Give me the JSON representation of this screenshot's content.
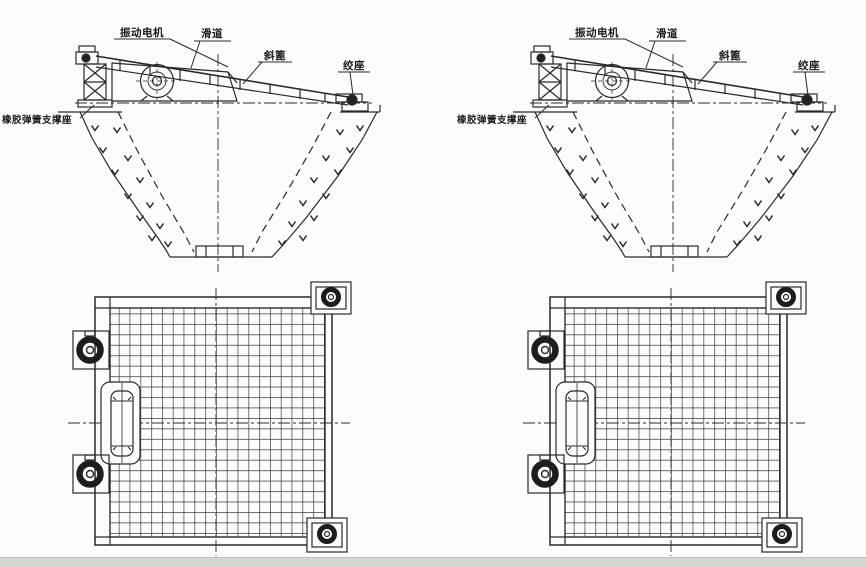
{
  "diagram": {
    "panels": [
      "left",
      "right"
    ],
    "labels": {
      "vibration_motor": "振动电机",
      "slideway": "滑道",
      "inclined_grate": "斜篦",
      "hinge_seat": "绞座",
      "rubber_spring_support": "橡胶弹簧支撑座"
    },
    "colors": {
      "ink": "#2a2a2a",
      "paper": "#fcfcfa",
      "grid_line": "#3c3c3c",
      "bottom_band": "#d3d7d4"
    }
  }
}
